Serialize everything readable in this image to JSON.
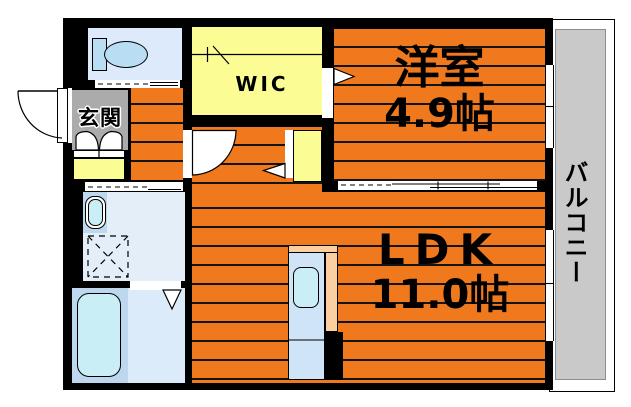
{
  "floorplan": {
    "rooms": {
      "entrance": {
        "label": "玄関"
      },
      "wic": {
        "label": "WIC"
      },
      "western_room": {
        "label": "洋室",
        "size": "4.9帖"
      },
      "ldk": {
        "label": "LDK",
        "size": "11.0帖"
      },
      "balcony": {
        "label": "バルコニー"
      }
    },
    "colors": {
      "floor_orange": "#f0791e",
      "storage_yellow": "#fcfc95",
      "entrance_gray": "#ababab",
      "balcony_gray": "#c9c9c9",
      "waterroom_blue": "#dceafb",
      "fixture_cyan": "#c9eef6",
      "kitchen_counter_peach": "#fbcfa0",
      "wall_black": "#000000"
    }
  }
}
